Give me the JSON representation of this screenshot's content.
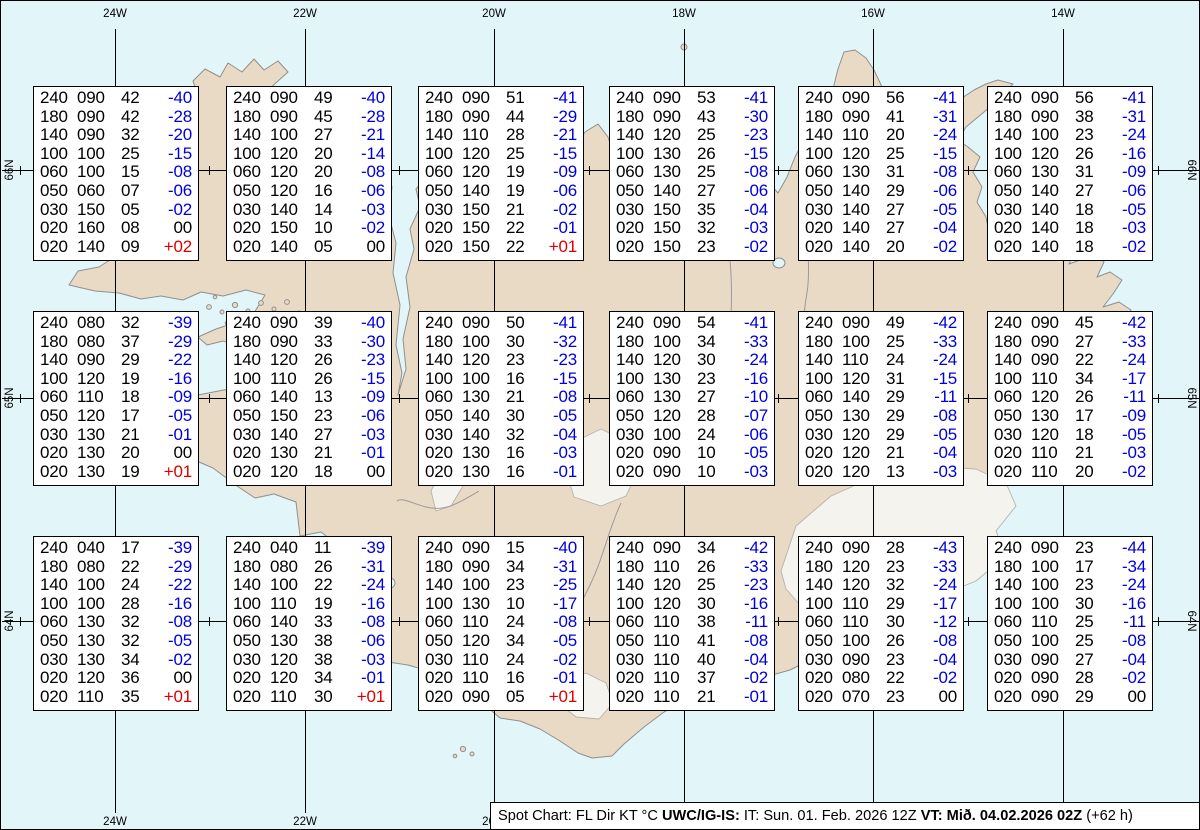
{
  "title": "Spot Chart",
  "colors": {
    "sea": "#e2f5f8",
    "land": "#e9dac6",
    "coastline": "#8f8f8f",
    "glacier": "#f5f3ee",
    "grid_line": "#000000",
    "negative_temp": "#0000dd",
    "positive_temp": "#dd0000",
    "box_background": "#ffffff"
  },
  "grid": {
    "meridian_labels": [
      "24W",
      "22W",
      "20W",
      "18W",
      "16W",
      "14W"
    ],
    "parallel_labels": [
      "66N",
      "65N",
      "64N"
    ]
  },
  "chart_data": {
    "type": "table",
    "title": "Spot Chart: FL Dir KT °C",
    "columns": [
      "FL",
      "Dir",
      "KT",
      "°C"
    ],
    "boxes": [
      {
        "grid_row": 1,
        "grid_col": 1,
        "rows": [
          [
            "240",
            "090",
            "42",
            "-40"
          ],
          [
            "180",
            "090",
            "42",
            "-28"
          ],
          [
            "140",
            "090",
            "32",
            "-20"
          ],
          [
            "100",
            "100",
            "25",
            "-15"
          ],
          [
            "060",
            "100",
            "15",
            "-08"
          ],
          [
            "050",
            "060",
            "07",
            "-06"
          ],
          [
            "030",
            "150",
            "05",
            "-02"
          ],
          [
            "020",
            "160",
            "08",
            "00"
          ],
          [
            "020",
            "140",
            "09",
            "+02"
          ]
        ]
      },
      {
        "grid_row": 1,
        "grid_col": 2,
        "rows": [
          [
            "240",
            "090",
            "49",
            "-40"
          ],
          [
            "180",
            "090",
            "45",
            "-28"
          ],
          [
            "140",
            "100",
            "27",
            "-21"
          ],
          [
            "100",
            "120",
            "20",
            "-14"
          ],
          [
            "060",
            "120",
            "20",
            "-08"
          ],
          [
            "050",
            "120",
            "16",
            "-06"
          ],
          [
            "030",
            "140",
            "14",
            "-03"
          ],
          [
            "020",
            "150",
            "10",
            "-02"
          ],
          [
            "020",
            "140",
            "05",
            "00"
          ]
        ]
      },
      {
        "grid_row": 1,
        "grid_col": 3,
        "rows": [
          [
            "240",
            "090",
            "51",
            "-41"
          ],
          [
            "180",
            "090",
            "44",
            "-29"
          ],
          [
            "140",
            "110",
            "28",
            "-21"
          ],
          [
            "100",
            "120",
            "25",
            "-15"
          ],
          [
            "060",
            "120",
            "19",
            "-09"
          ],
          [
            "050",
            "140",
            "19",
            "-06"
          ],
          [
            "030",
            "150",
            "21",
            "-02"
          ],
          [
            "020",
            "150",
            "22",
            "-01"
          ],
          [
            "020",
            "150",
            "22",
            "+01"
          ]
        ]
      },
      {
        "grid_row": 1,
        "grid_col": 4,
        "rows": [
          [
            "240",
            "090",
            "53",
            "-41"
          ],
          [
            "180",
            "090",
            "43",
            "-30"
          ],
          [
            "140",
            "120",
            "25",
            "-23"
          ],
          [
            "100",
            "130",
            "26",
            "-15"
          ],
          [
            "060",
            "130",
            "25",
            "-08"
          ],
          [
            "050",
            "140",
            "27",
            "-06"
          ],
          [
            "030",
            "150",
            "35",
            "-04"
          ],
          [
            "020",
            "150",
            "32",
            "-03"
          ],
          [
            "020",
            "150",
            "23",
            "-02"
          ]
        ]
      },
      {
        "grid_row": 1,
        "grid_col": 5,
        "rows": [
          [
            "240",
            "090",
            "56",
            "-41"
          ],
          [
            "180",
            "090",
            "41",
            "-31"
          ],
          [
            "140",
            "110",
            "20",
            "-24"
          ],
          [
            "100",
            "120",
            "25",
            "-15"
          ],
          [
            "060",
            "130",
            "31",
            "-08"
          ],
          [
            "050",
            "140",
            "29",
            "-06"
          ],
          [
            "030",
            "140",
            "27",
            "-05"
          ],
          [
            "020",
            "140",
            "27",
            "-04"
          ],
          [
            "020",
            "140",
            "20",
            "-02"
          ]
        ]
      },
      {
        "grid_row": 1,
        "grid_col": 6,
        "rows": [
          [
            "240",
            "090",
            "56",
            "-41"
          ],
          [
            "180",
            "090",
            "38",
            "-31"
          ],
          [
            "140",
            "100",
            "23",
            "-24"
          ],
          [
            "100",
            "120",
            "26",
            "-16"
          ],
          [
            "060",
            "130",
            "31",
            "-09"
          ],
          [
            "050",
            "140",
            "27",
            "-06"
          ],
          [
            "030",
            "140",
            "18",
            "-05"
          ],
          [
            "020",
            "140",
            "18",
            "-03"
          ],
          [
            "020",
            "140",
            "18",
            "-02"
          ]
        ]
      },
      {
        "grid_row": 2,
        "grid_col": 1,
        "rows": [
          [
            "240",
            "080",
            "32",
            "-39"
          ],
          [
            "180",
            "080",
            "37",
            "-29"
          ],
          [
            "140",
            "090",
            "29",
            "-22"
          ],
          [
            "100",
            "120",
            "19",
            "-16"
          ],
          [
            "060",
            "110",
            "18",
            "-09"
          ],
          [
            "050",
            "120",
            "17",
            "-05"
          ],
          [
            "030",
            "130",
            "21",
            "-01"
          ],
          [
            "020",
            "130",
            "20",
            "00"
          ],
          [
            "020",
            "130",
            "19",
            "+01"
          ]
        ]
      },
      {
        "grid_row": 2,
        "grid_col": 2,
        "rows": [
          [
            "240",
            "090",
            "39",
            "-40"
          ],
          [
            "180",
            "090",
            "33",
            "-30"
          ],
          [
            "140",
            "120",
            "26",
            "-23"
          ],
          [
            "100",
            "110",
            "26",
            "-15"
          ],
          [
            "060",
            "140",
            "13",
            "-09"
          ],
          [
            "050",
            "150",
            "23",
            "-06"
          ],
          [
            "030",
            "140",
            "27",
            "-03"
          ],
          [
            "020",
            "130",
            "21",
            "-01"
          ],
          [
            "020",
            "120",
            "18",
            "00"
          ]
        ]
      },
      {
        "grid_row": 2,
        "grid_col": 3,
        "rows": [
          [
            "240",
            "090",
            "50",
            "-41"
          ],
          [
            "180",
            "100",
            "30",
            "-32"
          ],
          [
            "140",
            "120",
            "23",
            "-23"
          ],
          [
            "100",
            "100",
            "16",
            "-15"
          ],
          [
            "060",
            "130",
            "21",
            "-08"
          ],
          [
            "050",
            "140",
            "30",
            "-05"
          ],
          [
            "030",
            "140",
            "32",
            "-04"
          ],
          [
            "020",
            "130",
            "16",
            "-03"
          ],
          [
            "020",
            "130",
            "16",
            "-01"
          ]
        ]
      },
      {
        "grid_row": 2,
        "grid_col": 4,
        "rows": [
          [
            "240",
            "090",
            "54",
            "-41"
          ],
          [
            "180",
            "100",
            "34",
            "-33"
          ],
          [
            "140",
            "120",
            "30",
            "-24"
          ],
          [
            "100",
            "130",
            "23",
            "-16"
          ],
          [
            "060",
            "130",
            "27",
            "-10"
          ],
          [
            "050",
            "120",
            "28",
            "-07"
          ],
          [
            "030",
            "100",
            "24",
            "-06"
          ],
          [
            "020",
            "090",
            "10",
            "-05"
          ],
          [
            "020",
            "090",
            "10",
            "-03"
          ]
        ]
      },
      {
        "grid_row": 2,
        "grid_col": 5,
        "rows": [
          [
            "240",
            "090",
            "49",
            "-42"
          ],
          [
            "180",
            "100",
            "25",
            "-33"
          ],
          [
            "140",
            "110",
            "24",
            "-24"
          ],
          [
            "100",
            "120",
            "31",
            "-15"
          ],
          [
            "060",
            "140",
            "29",
            "-11"
          ],
          [
            "050",
            "130",
            "29",
            "-08"
          ],
          [
            "030",
            "120",
            "29",
            "-05"
          ],
          [
            "020",
            "120",
            "21",
            "-04"
          ],
          [
            "020",
            "120",
            "13",
            "-03"
          ]
        ]
      },
      {
        "grid_row": 2,
        "grid_col": 6,
        "rows": [
          [
            "240",
            "090",
            "45",
            "-42"
          ],
          [
            "180",
            "090",
            "27",
            "-33"
          ],
          [
            "140",
            "090",
            "22",
            "-24"
          ],
          [
            "100",
            "110",
            "34",
            "-17"
          ],
          [
            "060",
            "120",
            "26",
            "-11"
          ],
          [
            "050",
            "130",
            "17",
            "-09"
          ],
          [
            "030",
            "120",
            "18",
            "-05"
          ],
          [
            "020",
            "110",
            "21",
            "-03"
          ],
          [
            "020",
            "110",
            "20",
            "-02"
          ]
        ]
      },
      {
        "grid_row": 3,
        "grid_col": 1,
        "rows": [
          [
            "240",
            "040",
            "17",
            "-39"
          ],
          [
            "180",
            "080",
            "22",
            "-29"
          ],
          [
            "140",
            "100",
            "24",
            "-22"
          ],
          [
            "100",
            "100",
            "28",
            "-16"
          ],
          [
            "060",
            "130",
            "32",
            "-08"
          ],
          [
            "050",
            "130",
            "32",
            "-05"
          ],
          [
            "030",
            "130",
            "34",
            "-02"
          ],
          [
            "020",
            "120",
            "36",
            "00"
          ],
          [
            "020",
            "110",
            "35",
            "+01"
          ]
        ]
      },
      {
        "grid_row": 3,
        "grid_col": 2,
        "rows": [
          [
            "240",
            "040",
            "11",
            "-39"
          ],
          [
            "180",
            "080",
            "26",
            "-31"
          ],
          [
            "140",
            "100",
            "22",
            "-24"
          ],
          [
            "100",
            "110",
            "19",
            "-16"
          ],
          [
            "060",
            "140",
            "33",
            "-08"
          ],
          [
            "050",
            "130",
            "38",
            "-06"
          ],
          [
            "030",
            "120",
            "38",
            "-03"
          ],
          [
            "020",
            "120",
            "34",
            "-01"
          ],
          [
            "020",
            "110",
            "30",
            "+01"
          ]
        ]
      },
      {
        "grid_row": 3,
        "grid_col": 3,
        "rows": [
          [
            "240",
            "090",
            "15",
            "-40"
          ],
          [
            "180",
            "090",
            "34",
            "-31"
          ],
          [
            "140",
            "100",
            "23",
            "-25"
          ],
          [
            "100",
            "130",
            "10",
            "-17"
          ],
          [
            "060",
            "110",
            "24",
            "-08"
          ],
          [
            "050",
            "120",
            "34",
            "-05"
          ],
          [
            "030",
            "110",
            "24",
            "-02"
          ],
          [
            "020",
            "110",
            "16",
            "-01"
          ],
          [
            "020",
            "090",
            "05",
            "+01"
          ]
        ]
      },
      {
        "grid_row": 3,
        "grid_col": 4,
        "rows": [
          [
            "240",
            "090",
            "34",
            "-42"
          ],
          [
            "180",
            "110",
            "26",
            "-33"
          ],
          [
            "140",
            "120",
            "25",
            "-23"
          ],
          [
            "100",
            "120",
            "30",
            "-16"
          ],
          [
            "060",
            "110",
            "38",
            "-11"
          ],
          [
            "050",
            "110",
            "41",
            "-08"
          ],
          [
            "030",
            "110",
            "40",
            "-04"
          ],
          [
            "020",
            "110",
            "37",
            "-02"
          ],
          [
            "020",
            "110",
            "21",
            "-01"
          ]
        ]
      },
      {
        "grid_row": 3,
        "grid_col": 5,
        "rows": [
          [
            "240",
            "090",
            "28",
            "-43"
          ],
          [
            "180",
            "120",
            "23",
            "-33"
          ],
          [
            "140",
            "120",
            "32",
            "-24"
          ],
          [
            "100",
            "110",
            "29",
            "-17"
          ],
          [
            "060",
            "110",
            "30",
            "-12"
          ],
          [
            "050",
            "100",
            "26",
            "-08"
          ],
          [
            "030",
            "090",
            "23",
            "-04"
          ],
          [
            "020",
            "080",
            "22",
            "-02"
          ],
          [
            "020",
            "070",
            "23",
            "00"
          ]
        ]
      },
      {
        "grid_row": 3,
        "grid_col": 6,
        "rows": [
          [
            "240",
            "090",
            "23",
            "-44"
          ],
          [
            "180",
            "100",
            "17",
            "-34"
          ],
          [
            "140",
            "100",
            "23",
            "-24"
          ],
          [
            "100",
            "100",
            "30",
            "-16"
          ],
          [
            "060",
            "110",
            "25",
            "-11"
          ],
          [
            "050",
            "100",
            "25",
            "-08"
          ],
          [
            "030",
            "090",
            "27",
            "-04"
          ],
          [
            "020",
            "090",
            "28",
            "-02"
          ],
          [
            "020",
            "090",
            "29",
            "00"
          ]
        ]
      }
    ]
  },
  "status_bar": {
    "segments": [
      {
        "text": "Spot Chart: FL Dir KT °C ",
        "bold": false
      },
      {
        "text": "UWC/IG-IS:",
        "bold": true
      },
      {
        "text": " IT: Sun. 01. Feb. 2026 12Z ",
        "bold": false
      },
      {
        "text": "VT: Mið. 04.02.2026 02Z",
        "bold": true
      },
      {
        "text": " (+62 h)",
        "bold": false
      }
    ]
  }
}
